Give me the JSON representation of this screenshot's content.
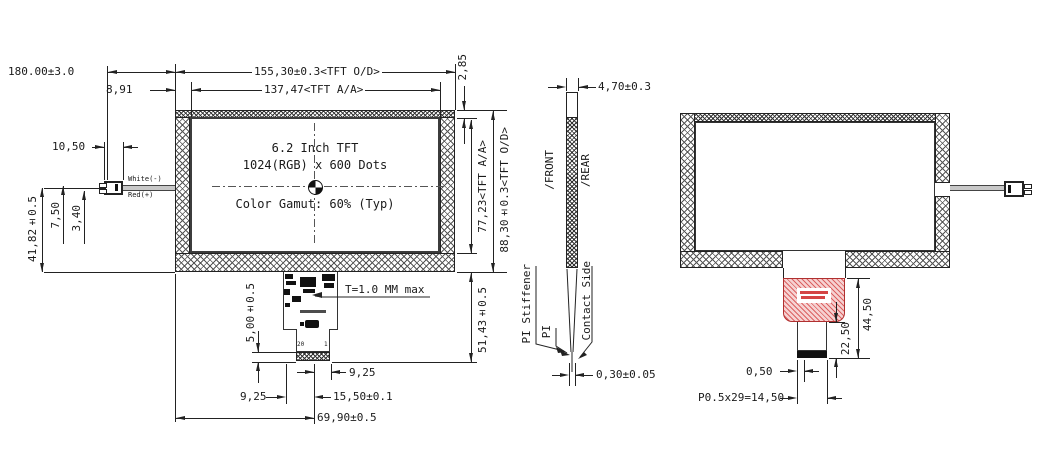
{
  "front_view": {
    "display": {
      "line1": "6.2 Inch TFT",
      "line2": "1024(RGB) x 600 Dots",
      "line3": "Color Gamut: 60% (Typ)"
    },
    "wires": {
      "white": "White(-)",
      "red": "Red(+)"
    },
    "fpc": {
      "pin_first": "20",
      "pin_last": "1",
      "thickness_note": "T=1.0 MM max"
    },
    "dims": {
      "wire_length": "180.00±3.0",
      "od_width": "155,30±0.3<TFT O/D>",
      "aa_width": "137,47<TFT A/A>",
      "left_margin": "8,91",
      "top_margin": "2,85",
      "aa_height": "77,23<TFT A/A>",
      "od_height": "88,30±0.3<TFT O/D>",
      "fpc_drop": "51,43±0.5",
      "connector_length": "10,50",
      "wire_gap_outer": "7,50",
      "wire_gap_inner": "3,40",
      "wire_pos": "41,82±0.5",
      "stiffener_len": "5,00±0.5",
      "fpc_right": "9,25",
      "fpc_left": "9,25",
      "contact_width": "15,50±0.1",
      "fpc_center": "69,90±0.5"
    }
  },
  "side_view": {
    "labels": {
      "front": "/FRONT",
      "rear": "/REAR",
      "pi_stiffener": "PI Stiffener",
      "pi": "PI",
      "contact_side": "Contact Side"
    },
    "dims": {
      "thickness": "4,70±0.3",
      "pi_thickness": "0,30±0.05"
    }
  },
  "rear_view": {
    "dims": {
      "fpc_length": "44,50",
      "tail_length": "22,50",
      "edge_offset": "0,50",
      "pitch": "P0.5x29=14,50"
    }
  }
}
